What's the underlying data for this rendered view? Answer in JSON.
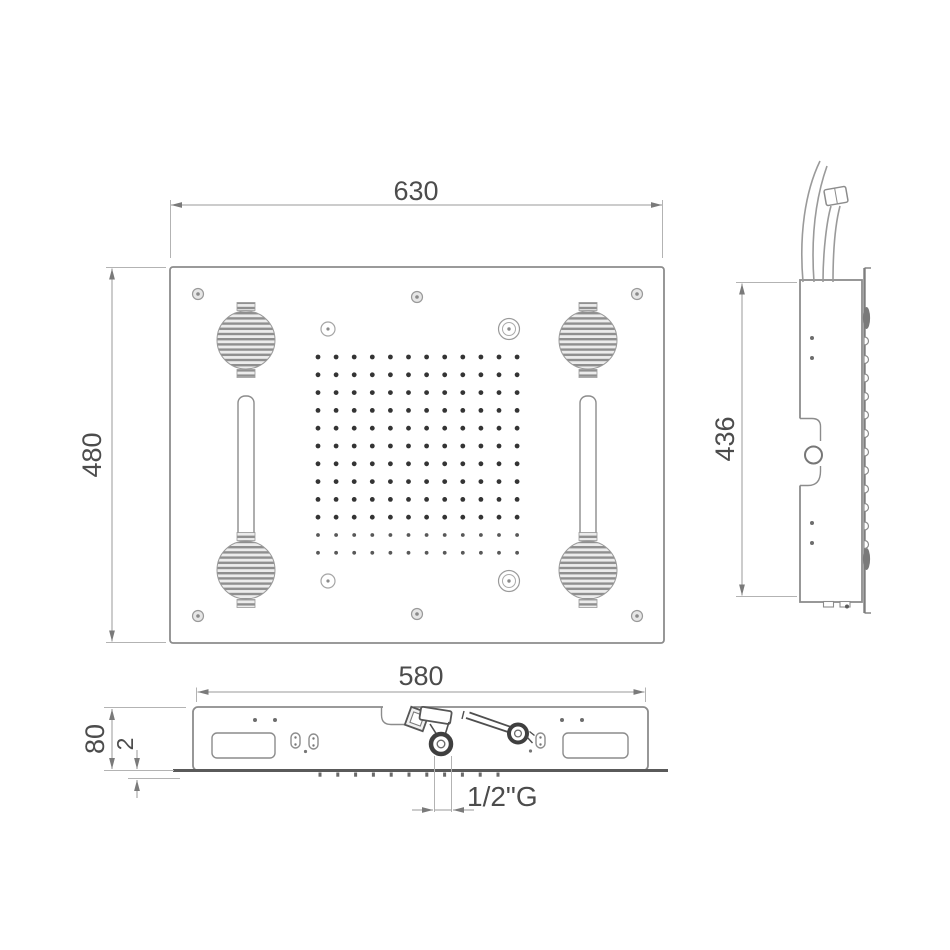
{
  "dimensions": {
    "front_width": "630",
    "front_height": "480",
    "side_height": "436",
    "section_width": "580",
    "section_depth": "80",
    "flange_thickness": "2",
    "connection": "1/2\"G"
  },
  "features": {
    "nozzle_rows": 12,
    "nozzle_cols": 12,
    "speaker_count": 4,
    "screw_count": 6,
    "light_slot_count": 2,
    "side_nozzle_bumps": 12,
    "section_nozzle_ticks": 11
  },
  "colors": {
    "background": "#ffffff",
    "outline": "#8c8c8c",
    "dimension_line": "#9a9a9a",
    "text": "#4c4c4c",
    "dark_detail": "#3f3f3f",
    "grille_fill": "#909090"
  }
}
